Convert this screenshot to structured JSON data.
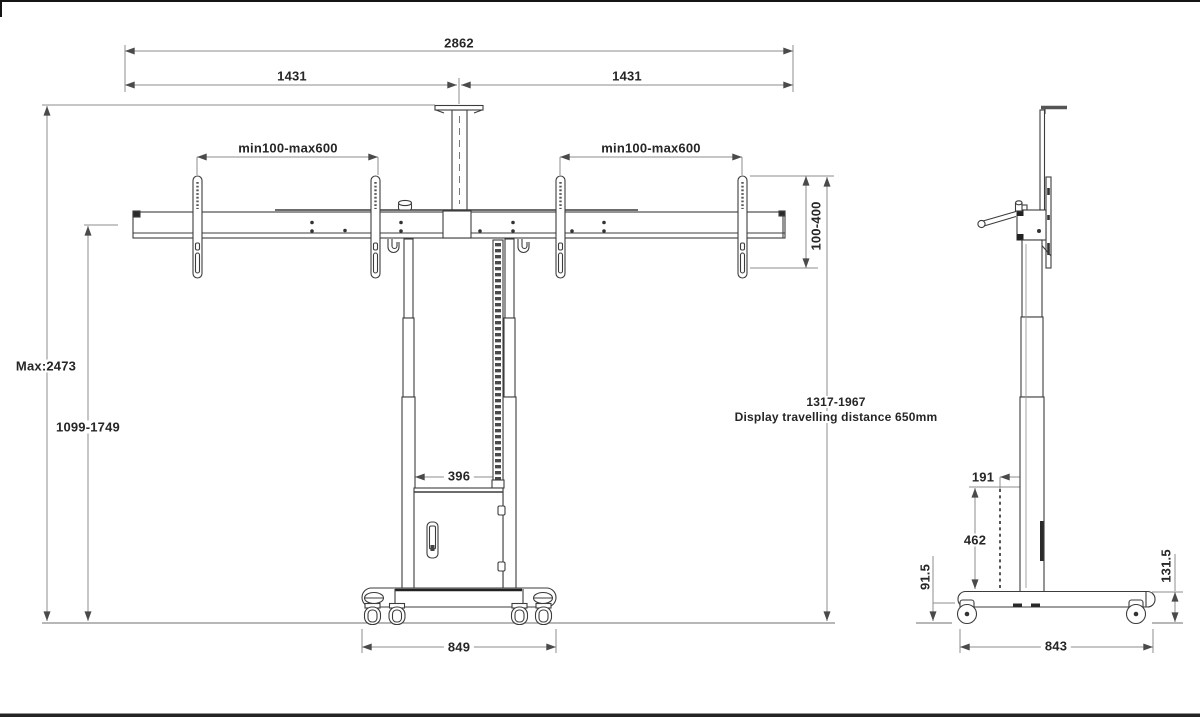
{
  "drawing_title": "Motorized dual-display floor stand — dimensioned technical drawing (front and side views)",
  "front_view": {
    "labels": {
      "overall_width": "2862",
      "left_half_width": "1431",
      "right_half_width": "1431",
      "vesa_left": "min100-max600",
      "vesa_right": "min100-max600",
      "bracket_height_range": "100-400",
      "max_height": "Max:2473",
      "height_range": "1099-1749",
      "column_width": "396",
      "wheelbase_width": "849",
      "travel_range": "1317-1967",
      "travel_note": "Display travelling distance 650mm"
    }
  },
  "side_view": {
    "labels": {
      "depth_offset": "191",
      "chain_height": "462",
      "caster_height": "91.5",
      "base_height": "131.5",
      "base_depth": "843"
    }
  },
  "colors": {
    "outline": "#3c3c3c",
    "dimension_line": "#8c8c8c",
    "arrow": "#4a4a4a",
    "text": "#262626",
    "background": "#ffffff"
  }
}
